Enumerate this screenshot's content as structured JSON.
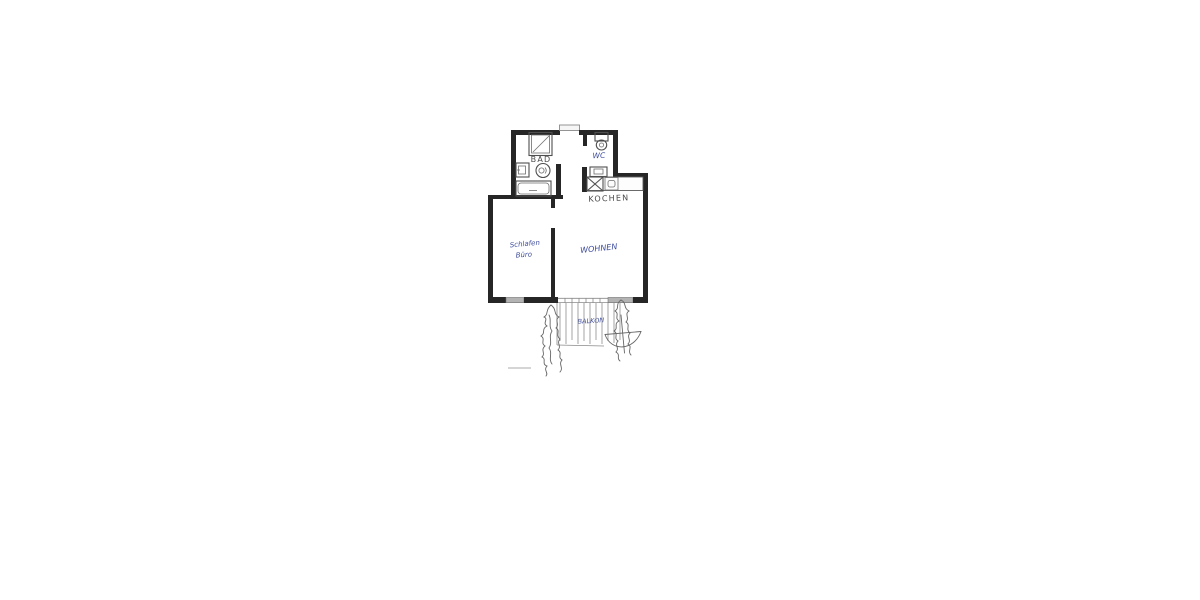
{
  "page": {
    "background_color": "#ffffff",
    "description": "Scanned hand-drawn apartment floor plan centered on white paper"
  },
  "floor_plan": {
    "colors": {
      "wall_ink": "#262626",
      "fixture_ink": "#4f4f4f",
      "pencil_text": "#4a4a4a",
      "blue_handwriting_ink": "#3e4c9c",
      "window_fill": "#b3b3b3",
      "balcony_hatch": "#9a9a9a"
    },
    "rooms": [
      {
        "id": "bad",
        "label": "BAD"
      },
      {
        "id": "wc",
        "label": "WC"
      },
      {
        "id": "kochen",
        "label": "KOCHEN"
      },
      {
        "id": "schlafen",
        "label_line1": "Schlafen",
        "label_line2": "Büro"
      },
      {
        "id": "wohnen",
        "label": "WOHNEN"
      },
      {
        "id": "balkon",
        "label": "BALKON"
      }
    ],
    "fixtures": [
      "shower",
      "bathroom-washbasin",
      "bathroom-toilet",
      "bathtub",
      "wc-toilet",
      "wc-washbasin",
      "stove",
      "kitchen-sink"
    ],
    "features": [
      "entry-door-top-center",
      "windows-in-bottom-wall",
      "balcony-door-band",
      "balcony-hatching",
      "plant-scribble-left",
      "plant-scribble-right",
      "round-table-scribble",
      "scale-mark"
    ]
  }
}
